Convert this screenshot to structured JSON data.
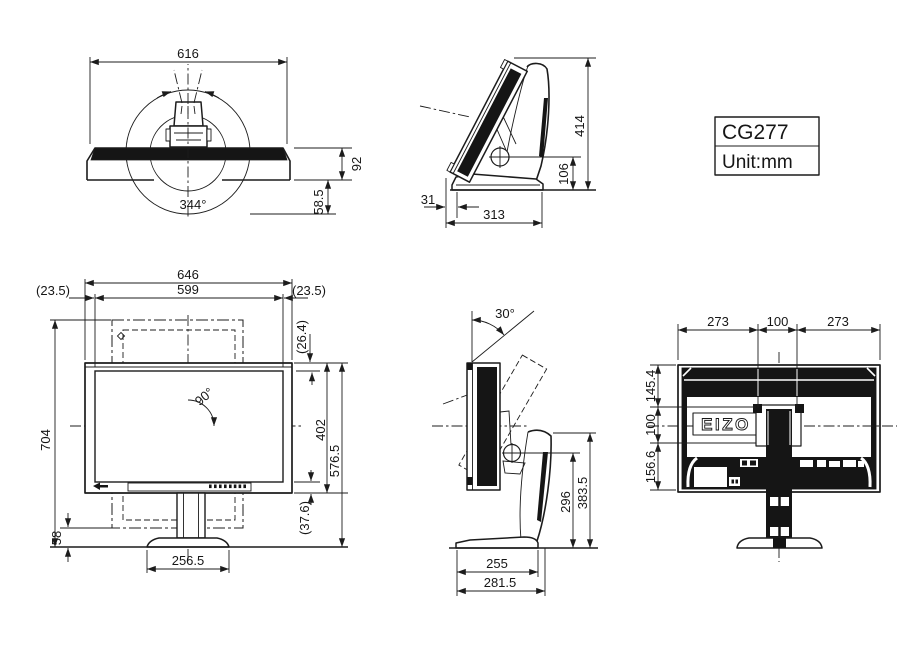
{
  "title_block": {
    "model": "CG277",
    "unit": "Unit:mm"
  },
  "brand": {
    "logo": "EIZO"
  },
  "top_view": {
    "width": "616",
    "thickness": "92",
    "base_extent": "58.5",
    "swivel_angle": "344°"
  },
  "tilt_side_view": {
    "height": "414",
    "pivot_height": "106",
    "foot_offset": "31",
    "depth": "313"
  },
  "front_view": {
    "total_width": "646",
    "screen_width": "599",
    "margin_left": "(23.5)",
    "margin_right": "(23.5)",
    "top_bezel": "(26.4)",
    "portrait_total_height": "704",
    "panel_height": "402",
    "top_height": "576.5",
    "bottom_bezel": "(37.6)",
    "portrait_clearance": "58",
    "base_width": "256.5",
    "pivot_angle": "90°"
  },
  "side_view": {
    "tilt_angle": "30°",
    "pivot_height": "296",
    "stand_top_height": "383.5",
    "base_depth": "255",
    "total_depth": "281.5"
  },
  "rear_view": {
    "span_left": "273",
    "vesa_width": "100",
    "span_right": "273",
    "top_to_vesa": "145.4",
    "vesa_height": "100",
    "vesa_to_bottom": "156.6"
  }
}
